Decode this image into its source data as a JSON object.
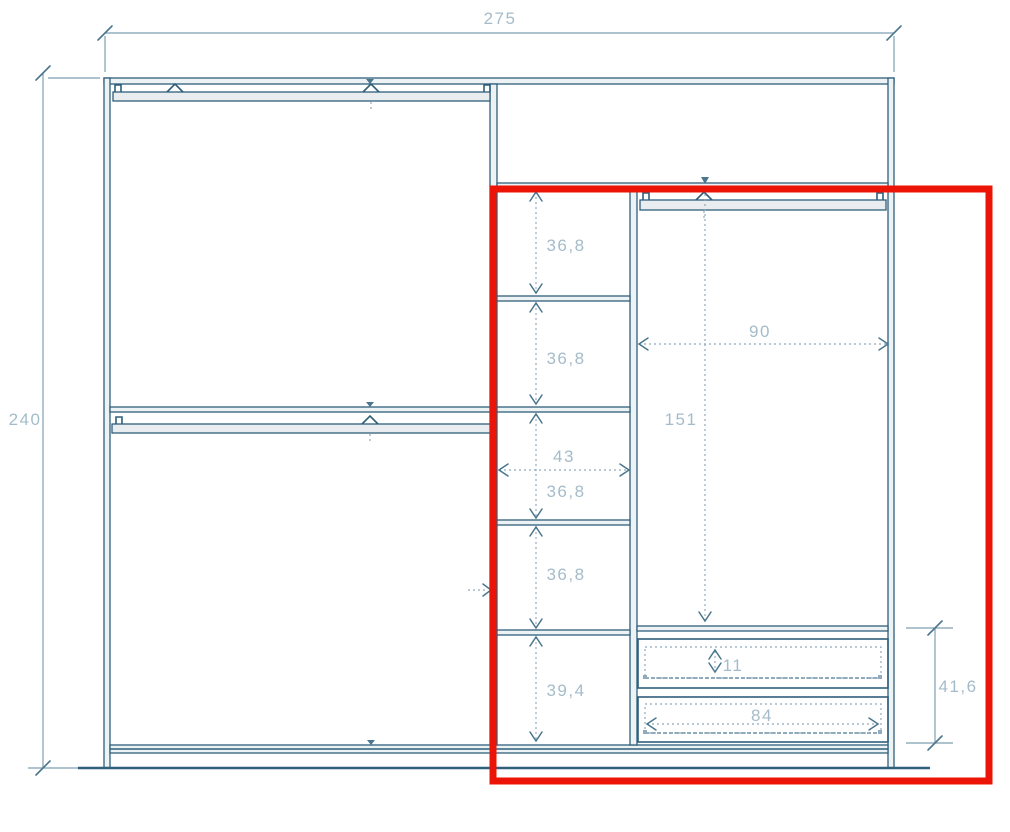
{
  "drawing": {
    "title": "wardrobe-elevation-technical-drawing",
    "units": "cm",
    "labels": {
      "overall_width": "275",
      "overall_height": "240",
      "shelf_gap_1": "36,8",
      "shelf_gap_2": "36,8",
      "shelf_column_width": "43",
      "shelf_gap_3": "36,8",
      "shelf_gap_4": "36,8",
      "bottom_compartment_height": "39,4",
      "hanging_section_width": "90",
      "hanging_section_height": "151",
      "drawer_front_height": "11",
      "drawer_front_width": "84",
      "drawer_unit_height": "41,6"
    },
    "colors": {
      "highlight_red": "#ec1407",
      "line_dark": "#2f5f7b",
      "line_dimension": "#7f9fb2",
      "label_text": "#a4bcca",
      "panel_fill": "#edf2f5"
    },
    "highlight": {
      "shape": "rectangle",
      "region": "right-half: shelf column, hanging section and drawer unit"
    }
  }
}
